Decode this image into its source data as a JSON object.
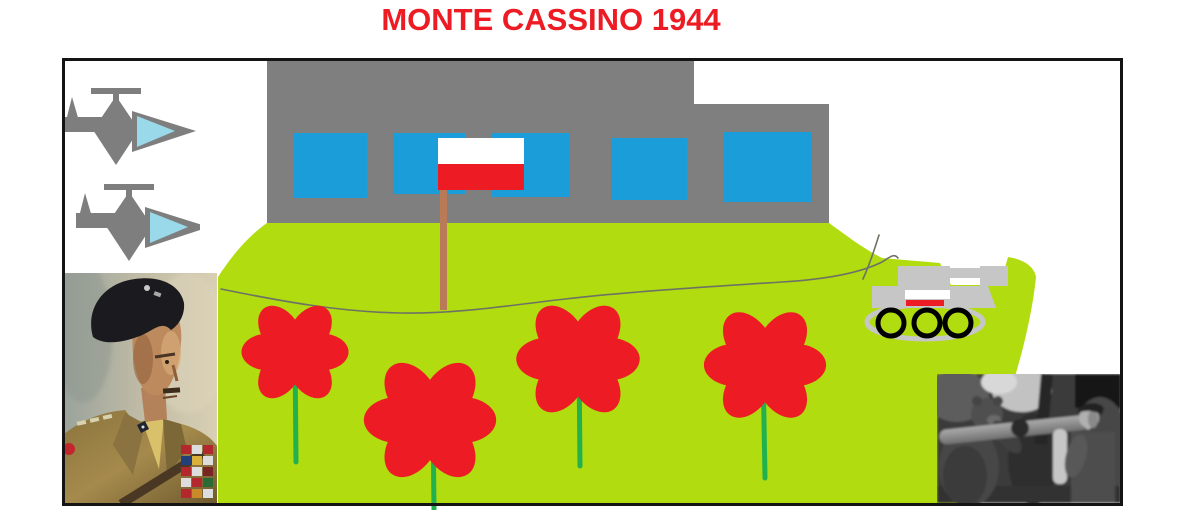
{
  "title": {
    "text": "MONTE CASSINO 1944"
  },
  "colors": {
    "title_red": "#ED1C24",
    "flag_red": "#ED1C24",
    "flower_red": "#ED1C24",
    "grass": "#B1DC10",
    "building_gray": "#7F7F7F",
    "window_blue": "#1A9DD9",
    "stem_green": "#22B14C",
    "pole_brown": "#B97A57",
    "tank_silver": "#C6C6C6",
    "plane_gray": "#7E7E7E",
    "cockpit_blue": "#99D9EA",
    "scribble_gray": "#6E7264",
    "frame_black": "#141414"
  },
  "scene": {
    "objects": [
      {
        "name": "monastery-building",
        "windows": 5
      },
      {
        "name": "polish-flag-on-pole",
        "stripes": [
          "white",
          "red"
        ]
      },
      {
        "name": "fighter-planes",
        "count": 2
      },
      {
        "name": "poppy-flowers",
        "count": 4
      },
      {
        "name": "tank-with-polish-marking",
        "wheels": 3
      },
      {
        "name": "general-portrait-photo"
      },
      {
        "name": "soldier-and-bear-photo"
      },
      {
        "name": "green-hillside-with-scribble-line"
      }
    ]
  }
}
